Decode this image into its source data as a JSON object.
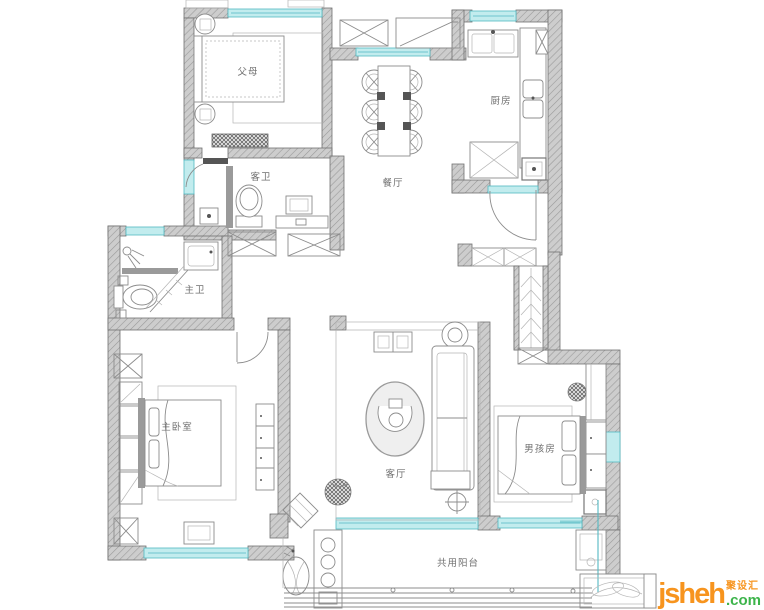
{
  "plan": {
    "rooms": [
      {
        "id": "bedroom-2",
        "label": "父母"
      },
      {
        "id": "guest-bathroom",
        "label": "客卫"
      },
      {
        "id": "master-bathroom",
        "label": "主卫"
      },
      {
        "id": "master-bedroom",
        "label": "主卧室"
      },
      {
        "id": "living-room",
        "label": "客厅"
      },
      {
        "id": "dining-room",
        "label": "餐厅"
      },
      {
        "id": "kitchen",
        "label": "厨房"
      },
      {
        "id": "boys-room",
        "label": "男孩房"
      },
      {
        "id": "shared-balcony",
        "label": "共用阳台"
      }
    ]
  },
  "watermark": {
    "brand": "jsheh",
    "suffix": ".com",
    "cn_name": "聚设汇"
  },
  "colors": {
    "bg": "#ffffff",
    "wall_edge": "#707070",
    "line": "#8c8c8c",
    "line_light": "#b5b5b5",
    "dark": "#555555",
    "window_fill": "#c2ecee",
    "window_edge": "#52b9c2",
    "label_color": "#6f6f6f",
    "wm_orange": "#f7941e",
    "wm_green": "#3cb44a"
  }
}
